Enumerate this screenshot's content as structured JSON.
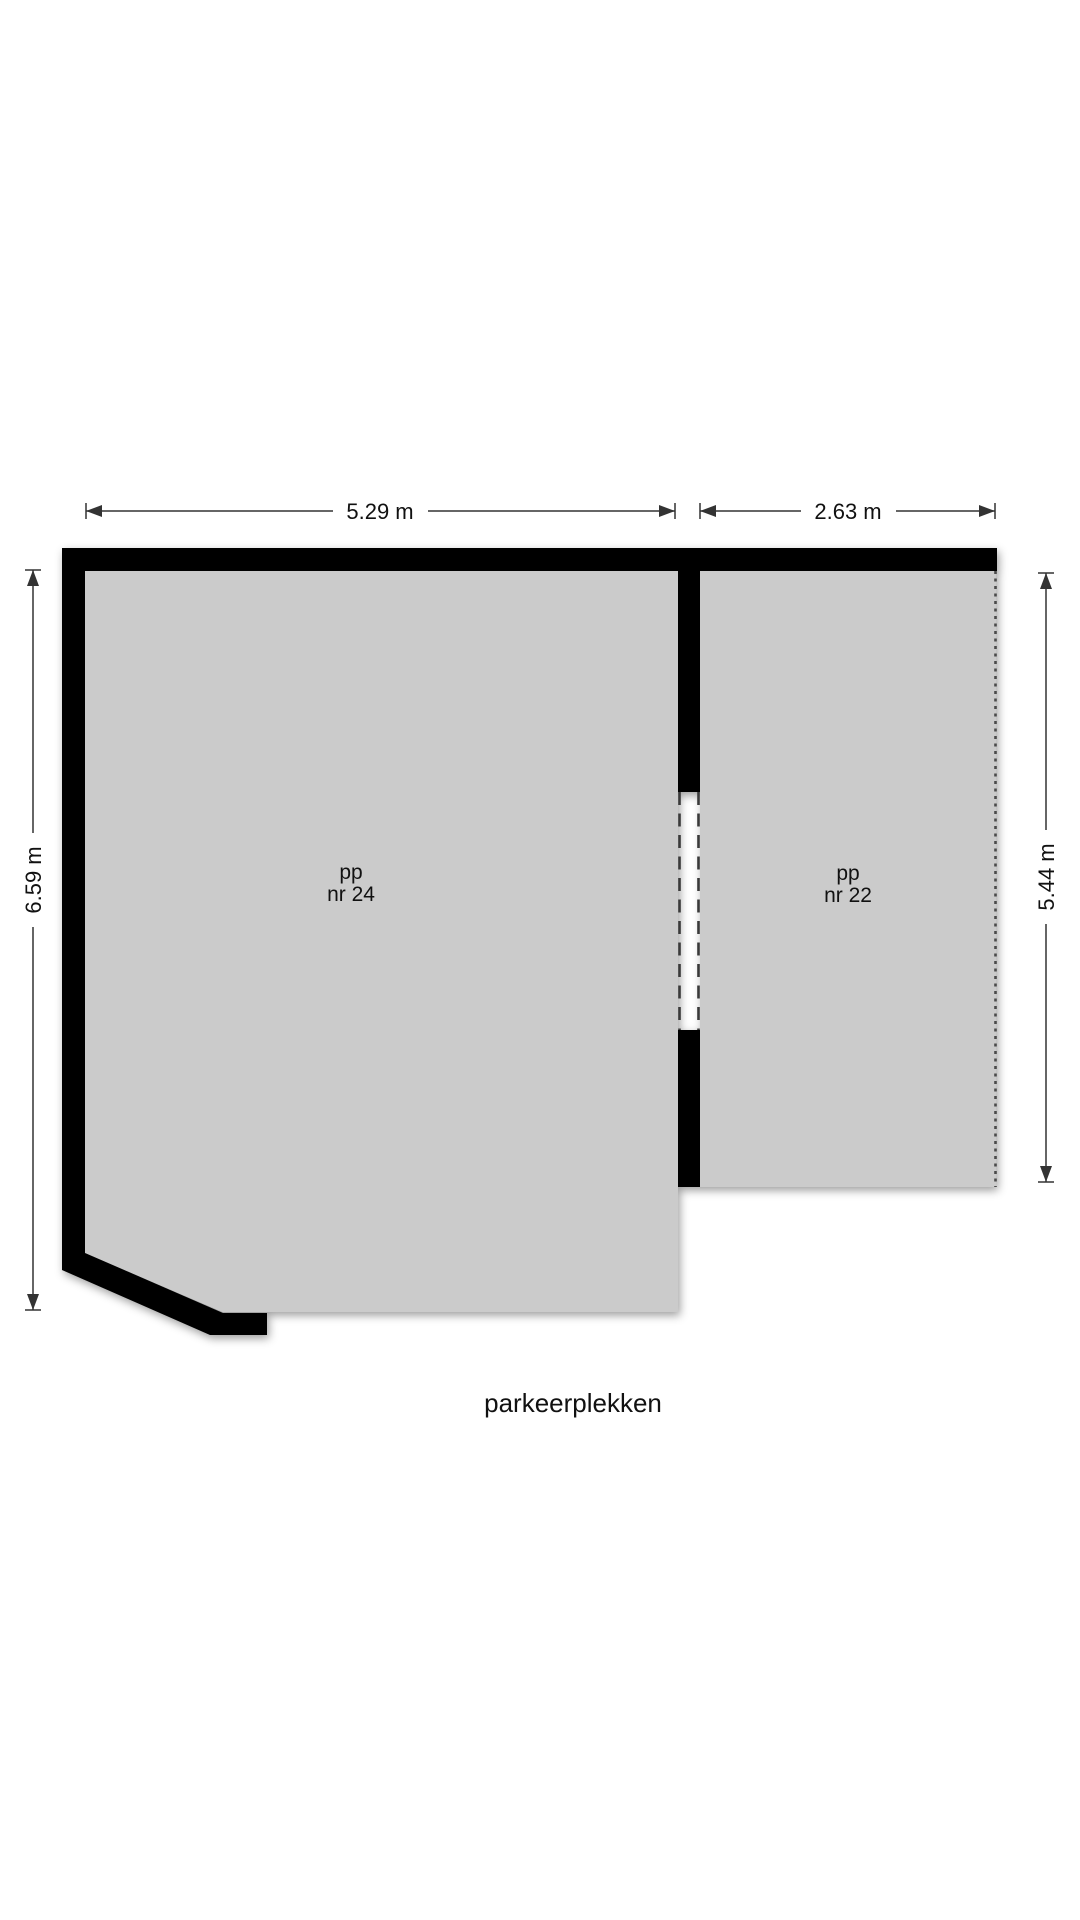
{
  "title": "parkeerplekken",
  "rooms": [
    {
      "id": "pp-nr-24",
      "label_top": "pp",
      "label_bottom": "nr 24"
    },
    {
      "id": "pp-nr-22",
      "label_top": "pp",
      "label_bottom": "nr 22"
    }
  ],
  "dimensions": {
    "top_left": "5.29 m",
    "top_right": "2.63 m",
    "left": "6.59 m",
    "right": "5.44 m"
  },
  "colors": {
    "wall": "#000000",
    "floor": "#cbcbcb",
    "background": "#ffffff",
    "dimension_line": "#333333",
    "dashed_opening": "#3a3a3a",
    "dotted_boundary": "#4a4a4a",
    "text": "#111111"
  }
}
